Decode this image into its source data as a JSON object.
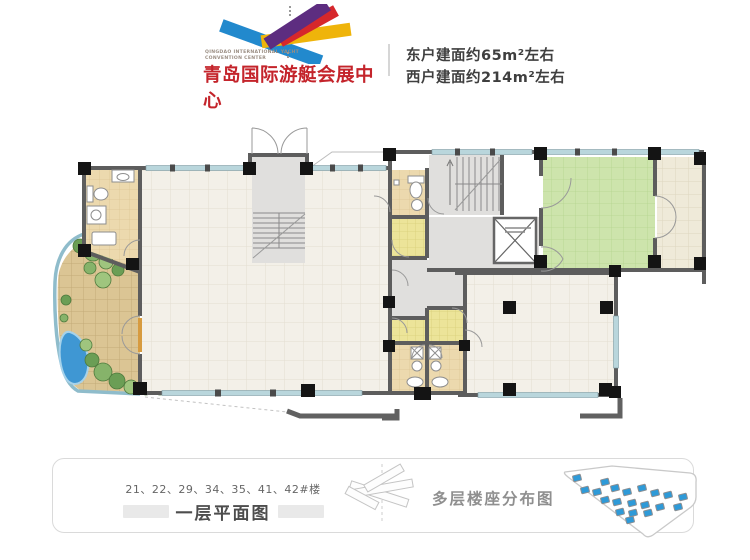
{
  "header": {
    "logo": {
      "english_line1": "QINGDAO INTERNATIONAL YACHT",
      "english_line2": "CONVENTION CENTER",
      "chinese_title": "青岛国际游艇会展中心",
      "title_color": "#c4242b",
      "colors": {
        "blue": "#2289cd",
        "yellow": "#efb40a",
        "red": "#d6272b",
        "purple": "#5d2d80"
      }
    },
    "east_area_line": "东户建面约65m²左右",
    "west_area_line": "西户建面约214m²左右"
  },
  "footer": {
    "buildings_line": "21、22、29、34、35、41、42#楼",
    "plan_title": "一层平面图",
    "distribution_title": "多层楼座分布图"
  },
  "site_map": {
    "marker_color": "#2e9ad8",
    "marker_edge": "#8a8f94",
    "markers": [
      [
        27,
        23
      ],
      [
        55,
        27
      ],
      [
        35,
        35
      ],
      [
        47,
        37
      ],
      [
        65,
        33
      ],
      [
        77,
        37
      ],
      [
        92,
        33
      ],
      [
        105,
        38
      ],
      [
        118,
        40
      ],
      [
        133,
        42
      ],
      [
        55,
        45
      ],
      [
        67,
        47
      ],
      [
        82,
        48
      ],
      [
        95,
        50
      ],
      [
        110,
        52
      ],
      [
        128,
        52
      ],
      [
        70,
        57
      ],
      [
        83,
        58
      ],
      [
        98,
        58
      ],
      [
        80,
        65
      ]
    ]
  },
  "plan_colors": {
    "wall": "#5d5d5d",
    "window": "#b9d6dc",
    "floor_cream": "#f3f0e8",
    "floor_tan": "#ecd9ae",
    "floor_yellow": "#ece499",
    "floor_green": "#cde4ac",
    "floor_gray": "#e0dfdd",
    "patio_stone": "#dbc594",
    "pond": "#3f97d3",
    "plant": "#6b9e55"
  }
}
